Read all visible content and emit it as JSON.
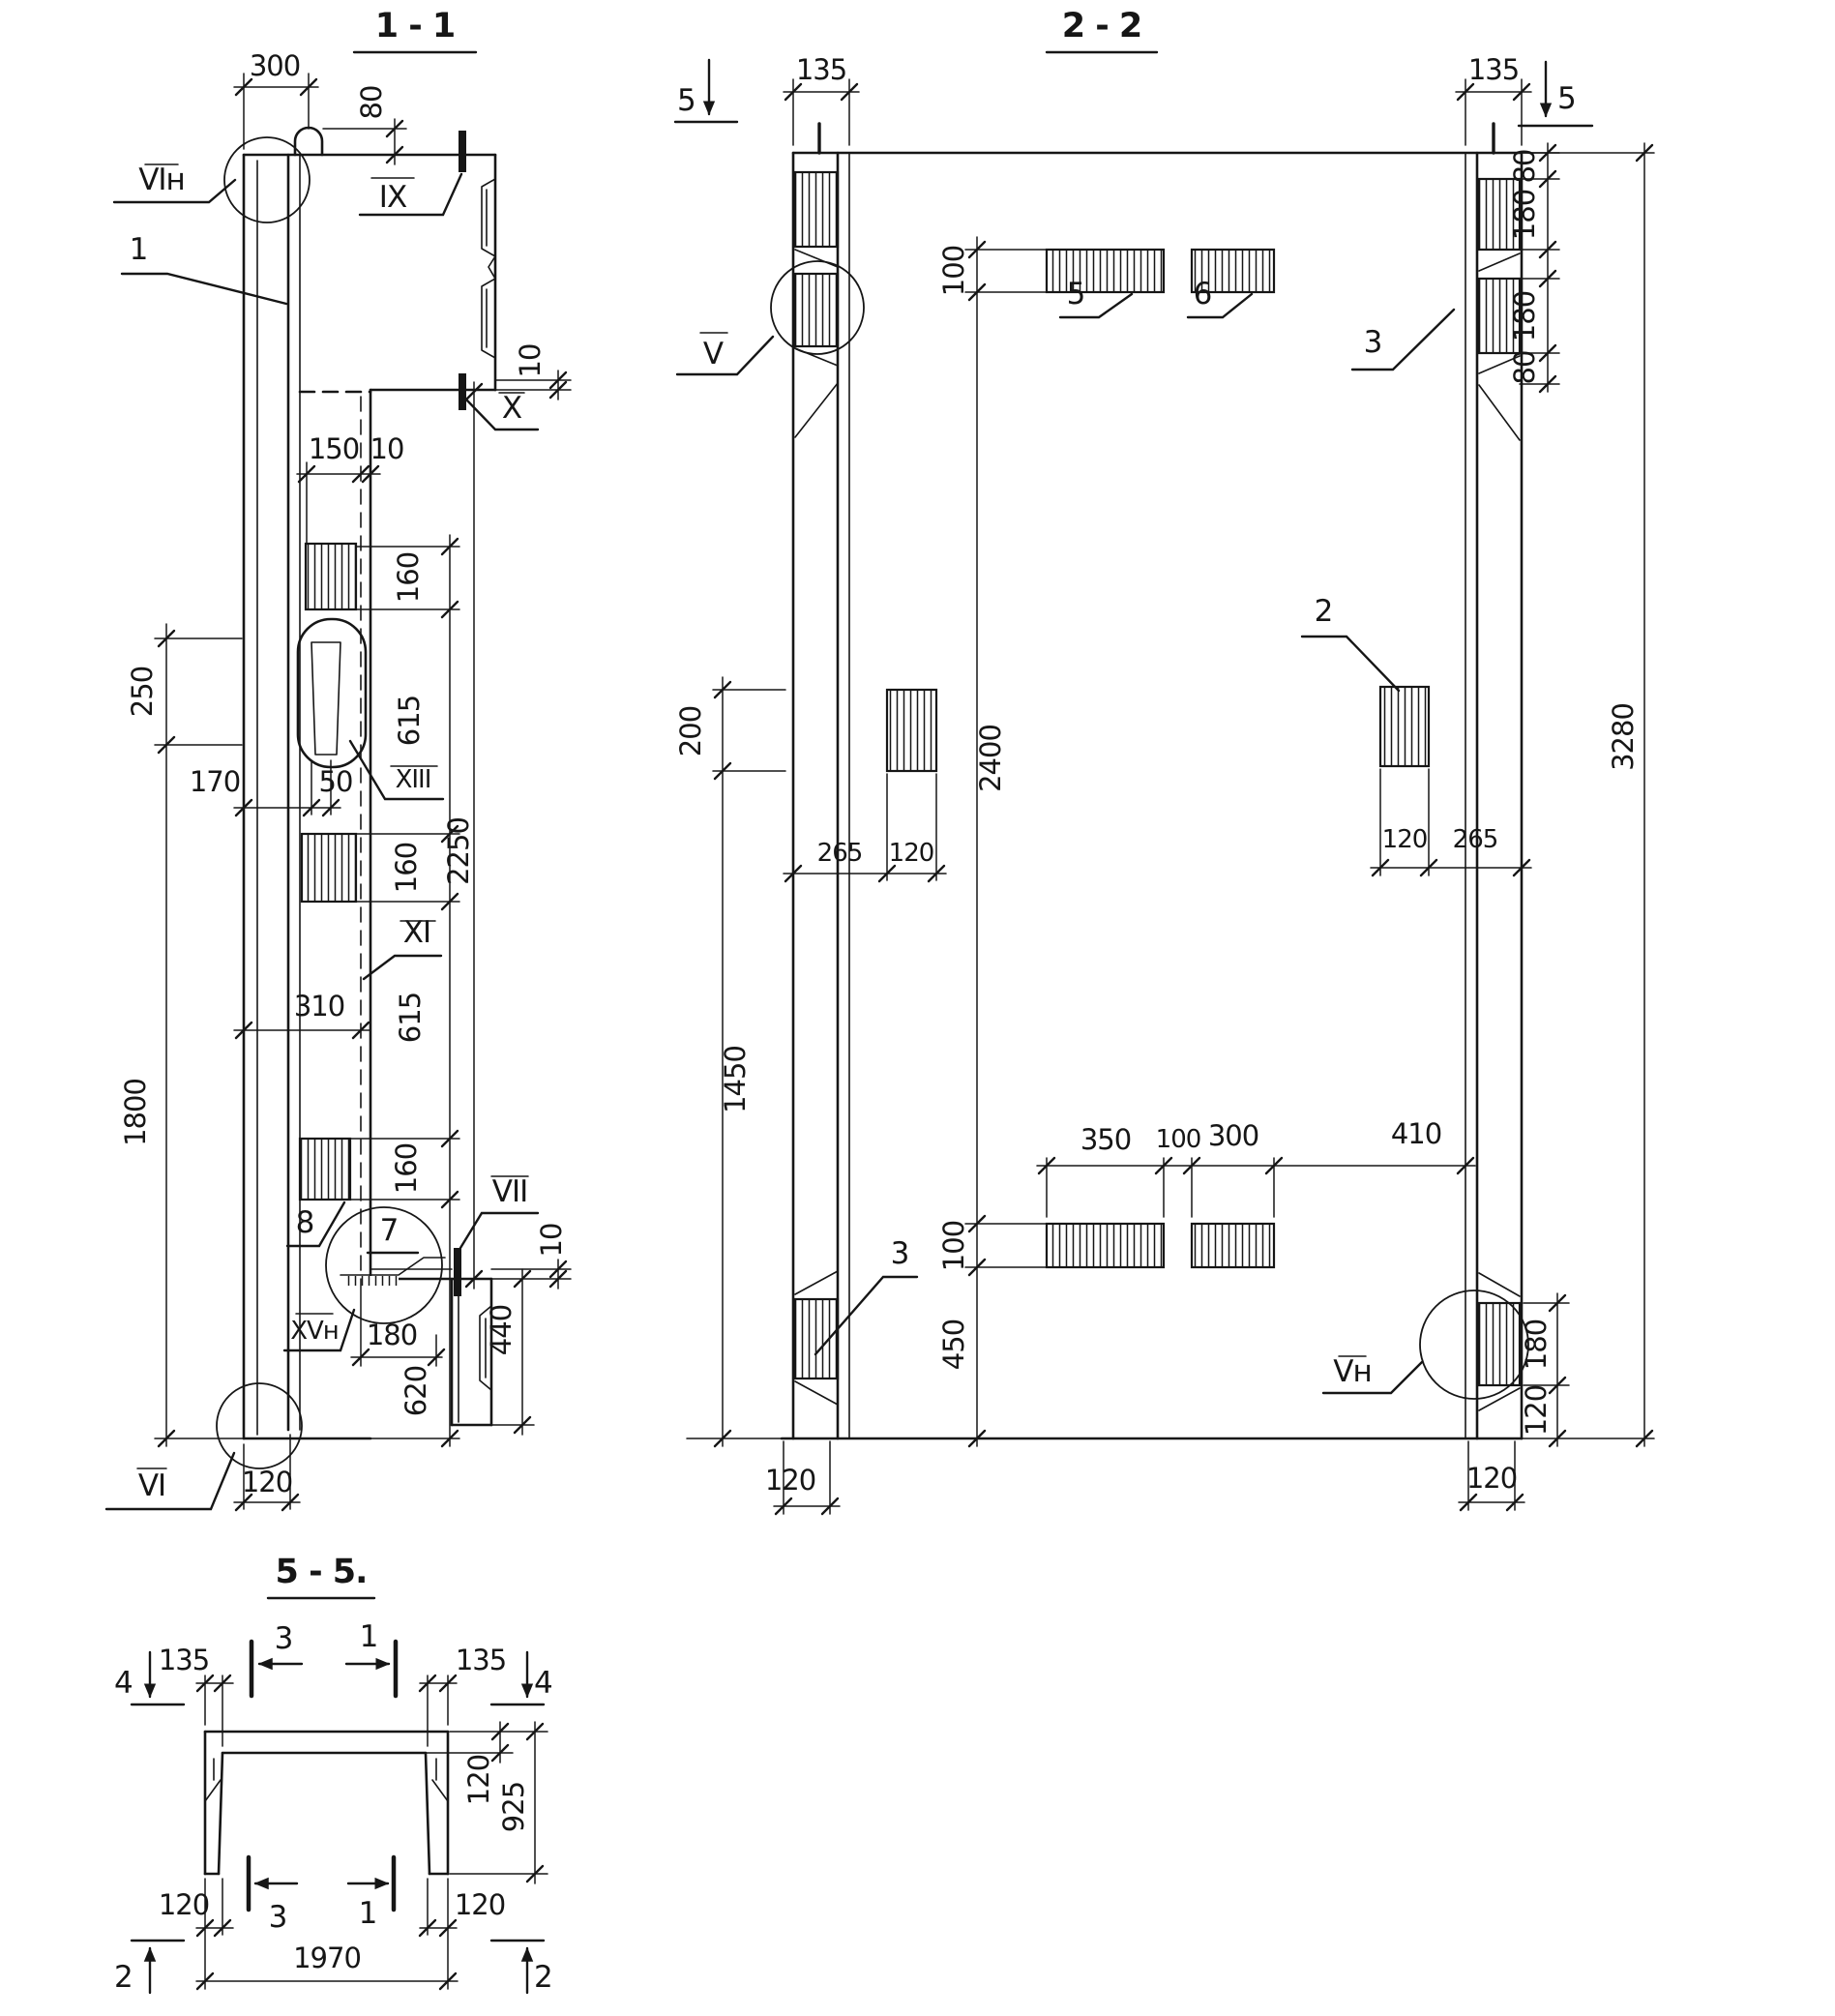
{
  "s11": {
    "title": "1 - 1",
    "d300": "300",
    "d80": "80",
    "d10t": "10",
    "l_vin": "VIн",
    "l_ix": "IX",
    "l_1": "1",
    "l_x": "X",
    "d150": "150",
    "d10w": "10",
    "d160a": "160",
    "d615a": "615",
    "d250": "250",
    "d170": "170",
    "d50": "50",
    "l_xiii": "XIII",
    "d160b": "160",
    "l_xi": "XI",
    "d310": "310",
    "d615b": "615",
    "d2250": "2250",
    "d1800": "1800",
    "d160c": "160",
    "l_8": "8",
    "l_7": "7",
    "l_vii": "VII",
    "d10b": "10",
    "l_xvn": "XVн",
    "d180": "180",
    "d440": "440",
    "d620": "620",
    "d120": "120",
    "l_vi": "VI"
  },
  "s22": {
    "title": "2 - 2",
    "m5l": "5",
    "m5r": "5",
    "d135l": "135",
    "d135r": "135",
    "d80a": "80",
    "d180a": "180",
    "d180b": "180",
    "d80b": "80",
    "d100t": "100",
    "l_5": "5",
    "l_6": "6",
    "l_v": "V",
    "l_3r": "3",
    "l_2": "2",
    "d200": "200",
    "d265l": "265",
    "d120l": "120",
    "d2400": "2400",
    "d3280": "3280",
    "d120r": "120",
    "d265r": "265",
    "d1450": "1450",
    "d350": "350",
    "d100m": "100",
    "d300": "300",
    "d410": "410",
    "d100b": "100",
    "d450": "450",
    "l_3l": "3",
    "l_vn": "Vн",
    "d180r": "180",
    "d120rb": "120",
    "d120bl": "120",
    "d120br": "120"
  },
  "s55": {
    "title": "5 - 5.",
    "m4l": "4",
    "m4r": "4",
    "m2l": "2",
    "m2r": "2",
    "m3t": "3",
    "m1t": "1",
    "m3b": "3",
    "m1b": "1",
    "d135l": "135",
    "d135r": "135",
    "d120r": "120",
    "d925": "925",
    "d120bl": "120",
    "d120br": "120",
    "d1970": "1970"
  }
}
